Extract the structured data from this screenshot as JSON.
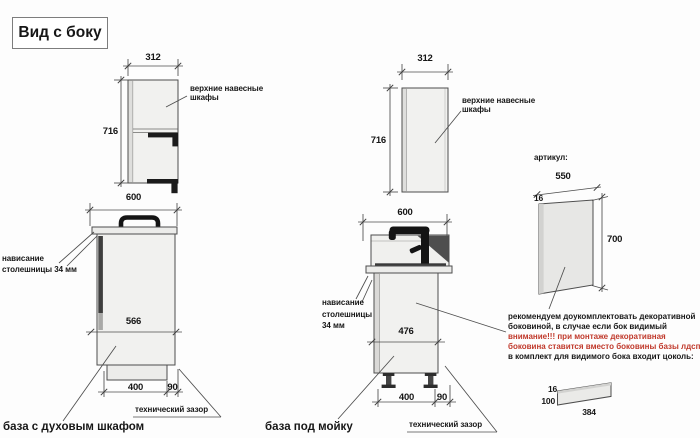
{
  "title": "Вид с боку",
  "colors": {
    "line": "#4d4d4d",
    "cabinet_fill": "#f1f1ef",
    "dark_detail": "#1b1b1b",
    "warning_text": "#c0392b"
  },
  "oven_group": {
    "caption": "база с духовым шкафом",
    "wall_width": "312",
    "wall_height": "716",
    "wall_label_1": "верхние навесные",
    "wall_label_2": "шкафы",
    "base_width": "600",
    "base_inner": "566",
    "plinth_width": "400",
    "gap": "90",
    "overhang_1": "нависание",
    "overhang_2": "столешницы 34 мм",
    "gap_label": "технический зазор"
  },
  "sink_group": {
    "caption": "база под мойку",
    "wall_width": "312",
    "wall_height": "716",
    "wall_label_1": "верхние навесные",
    "wall_label_2": "шкафы",
    "base_width": "600",
    "base_inner": "476",
    "plinth_width": "400",
    "gap": "90",
    "overhang_1": "нависание",
    "overhang_2": "столешницы",
    "overhang_3": "34 мм",
    "gap_label": "технический зазор"
  },
  "panel_group": {
    "heading": "артикул:",
    "panel_width": "550",
    "panel_thickness": "16",
    "panel_height": "700",
    "note_1": "рекомендуем доукомплектовать декоративной",
    "note_2": "боковиной, в случае если бок видимый",
    "note_3": "внимание!!! при монтаже декоративная",
    "note_4": "боковина ставится вместо боковины базы лдсп",
    "note_5": "в комплект для видимого бока входит цоколь:",
    "plinth_thickness": "16",
    "plinth_height": "100",
    "plinth_length": "384"
  }
}
